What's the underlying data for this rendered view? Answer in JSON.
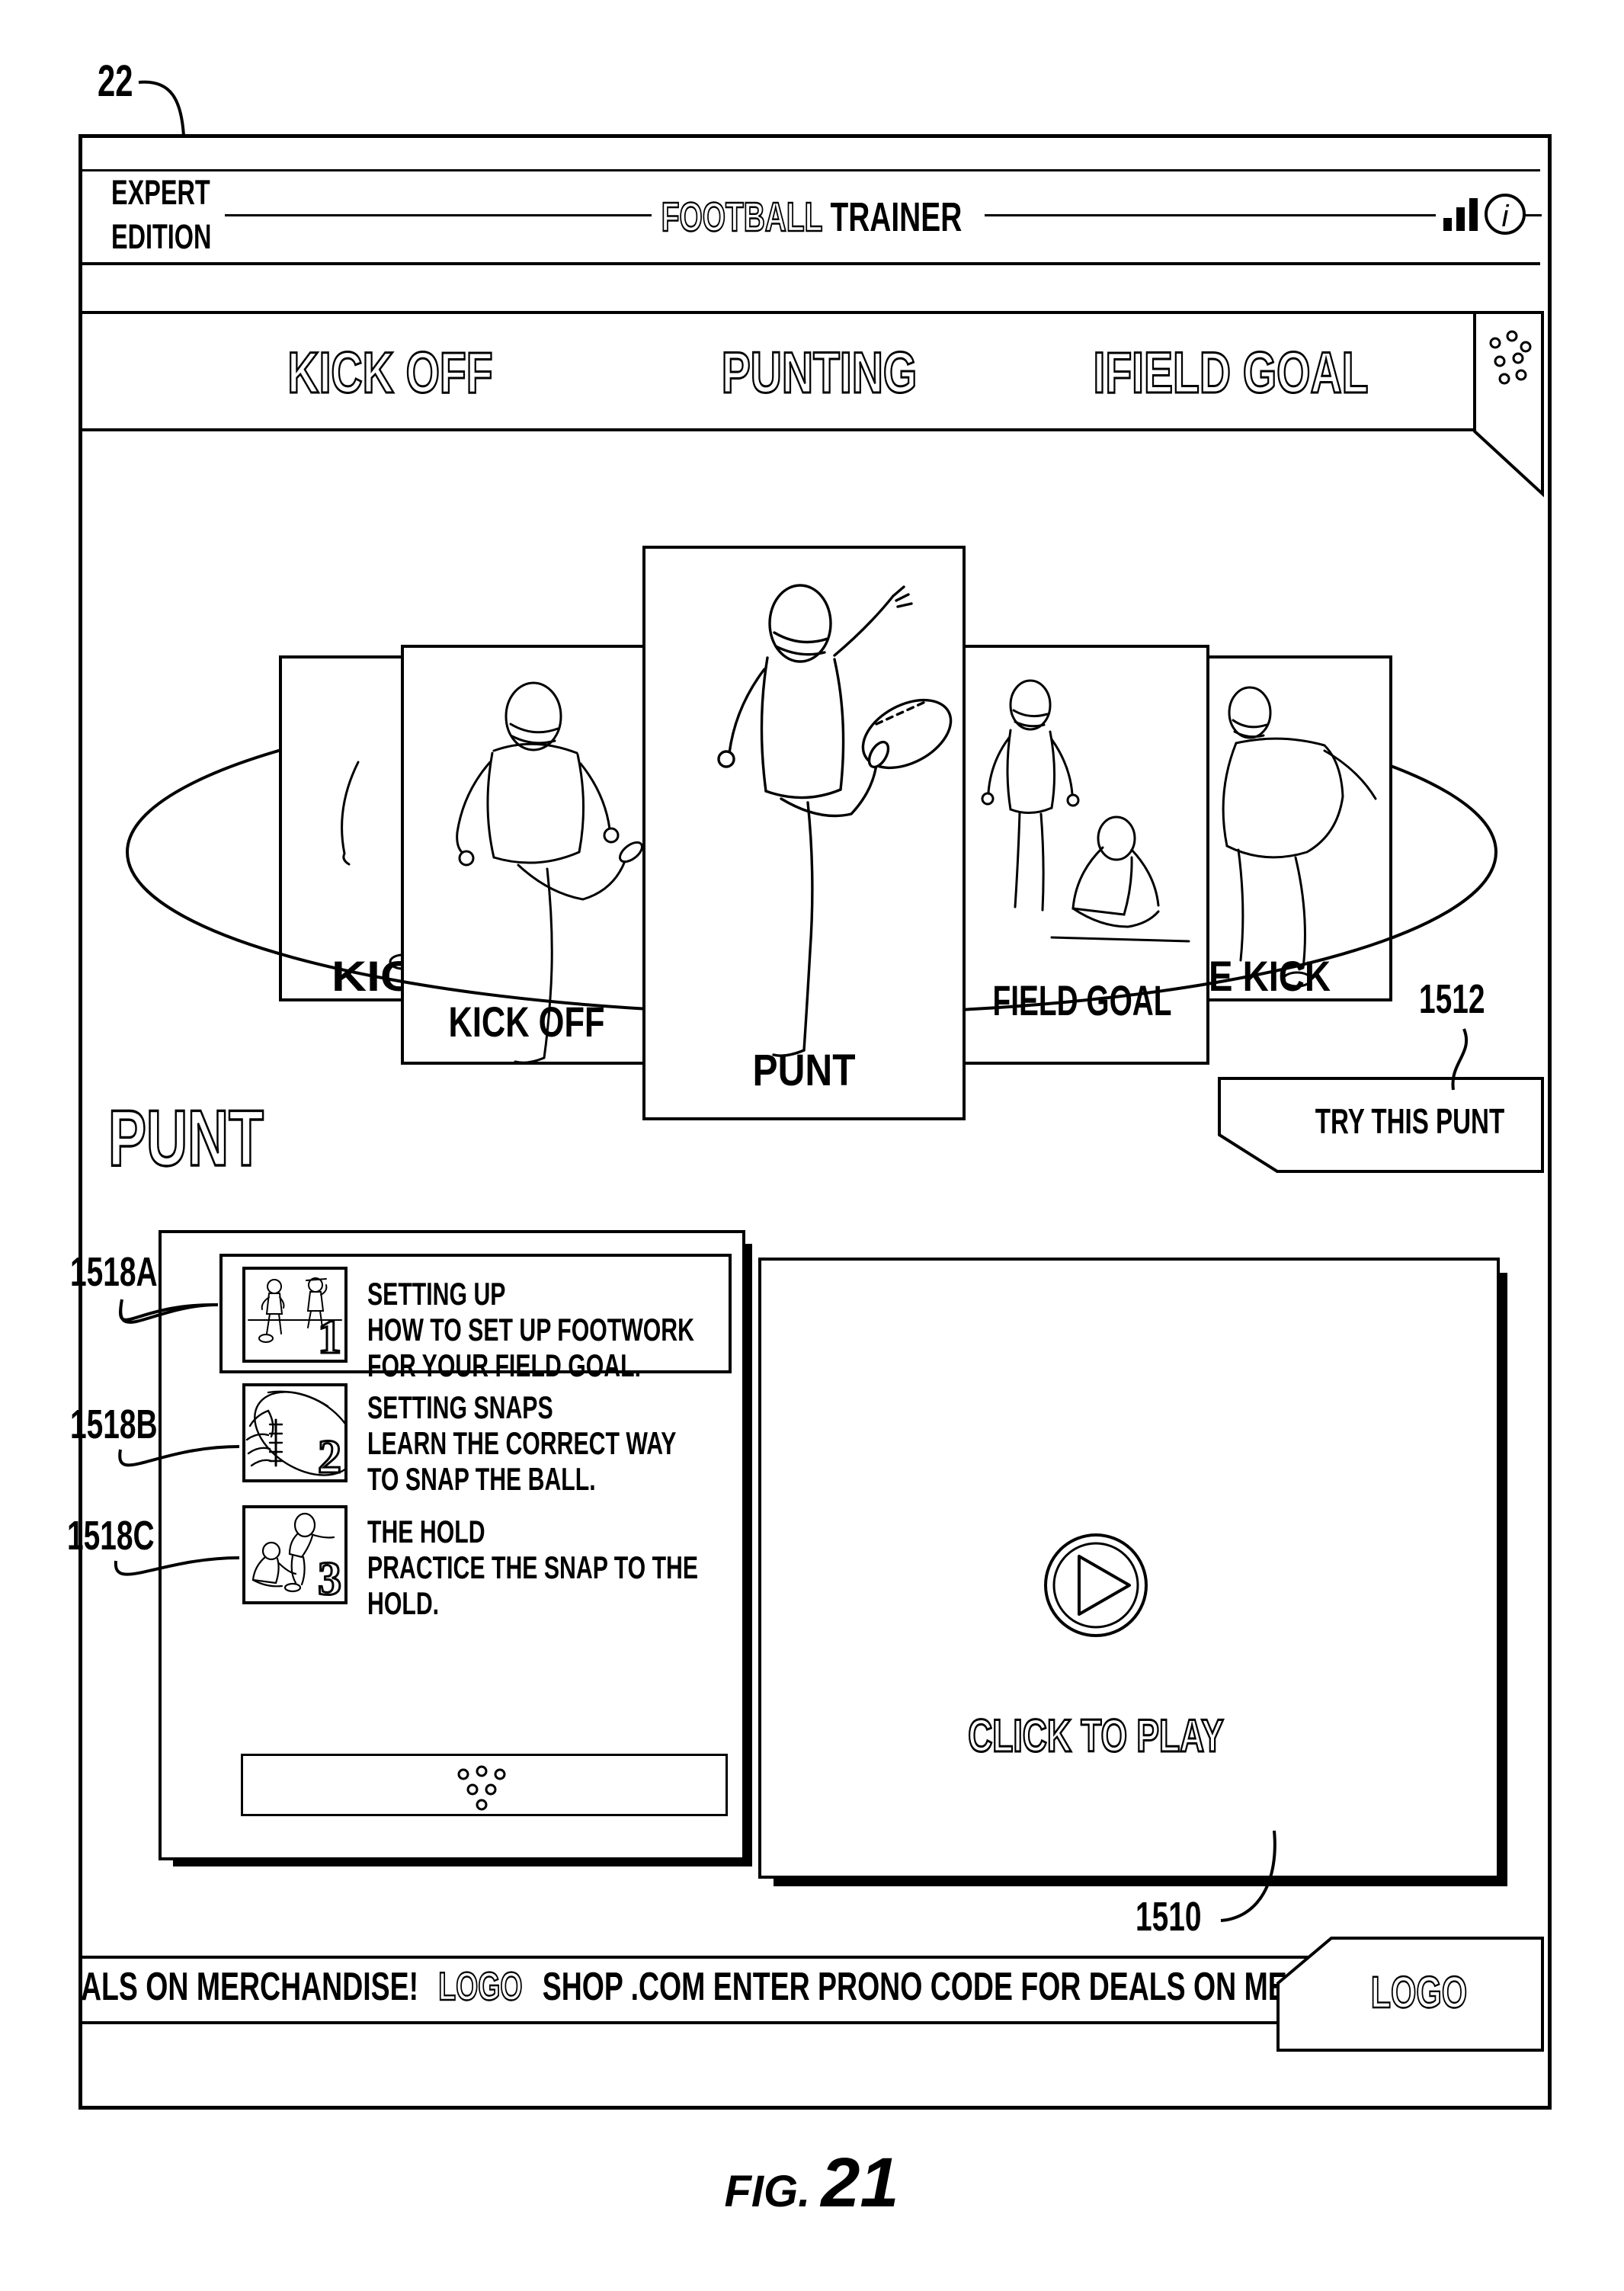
{
  "figure": {
    "frame_ref": "22",
    "caption_prefix": "FIG.",
    "caption_number": "21"
  },
  "header": {
    "edition_line1": "EXPERT",
    "edition_line2": "EDITION",
    "title_outline": "FOOTBALL",
    "title_solid": "TRAINER",
    "icons": [
      "signal-bars-icon",
      "info-icon"
    ]
  },
  "nav": {
    "items": [
      {
        "label": "KICK OFF"
      },
      {
        "label": "PUNTING"
      },
      {
        "label": "IFIELD GOAL"
      }
    ],
    "menu_icon": "menu-dots-icon"
  },
  "carousel": {
    "cards": [
      {
        "label": "KIC"
      },
      {
        "label": "KICK OFF"
      },
      {
        "label": "PUNT"
      },
      {
        "label": "FIELD GOAL"
      },
      {
        "label": "E KICK"
      }
    ]
  },
  "section": {
    "heading": "PUNT"
  },
  "try_button": {
    "ref": "1512",
    "label": "TRY THIS PUNT"
  },
  "steps": {
    "items": [
      {
        "ref": "1518A",
        "num": "1",
        "title": "SETTING UP",
        "line1": "HOW TO SET UP FOOTWORK",
        "line2": "FOR YOUR FIELD GOAL."
      },
      {
        "ref": "1518B",
        "num": "2",
        "title": "SETTING SNAPS",
        "line1": "LEARN THE CORRECT WAY",
        "line2": "TO SNAP THE BALL."
      },
      {
        "ref": "1518C",
        "num": "3",
        "title": "THE HOLD",
        "line1": "PRACTICE THE SNAP TO THE",
        "line2": "HOLD."
      }
    ],
    "more_icon": "more-dots-icon"
  },
  "video": {
    "ref": "1510",
    "cta": "CLICK TO PLAY",
    "play_icon": "play-icon"
  },
  "ticker": {
    "left_text": "ALS ON MERCHANDISE!",
    "logo_inline": "LOGO",
    "right_text": "SHOP .COM ENTER PRONO CODE FOR DEALS ON MERCH",
    "badge_logo": "LOGO"
  }
}
